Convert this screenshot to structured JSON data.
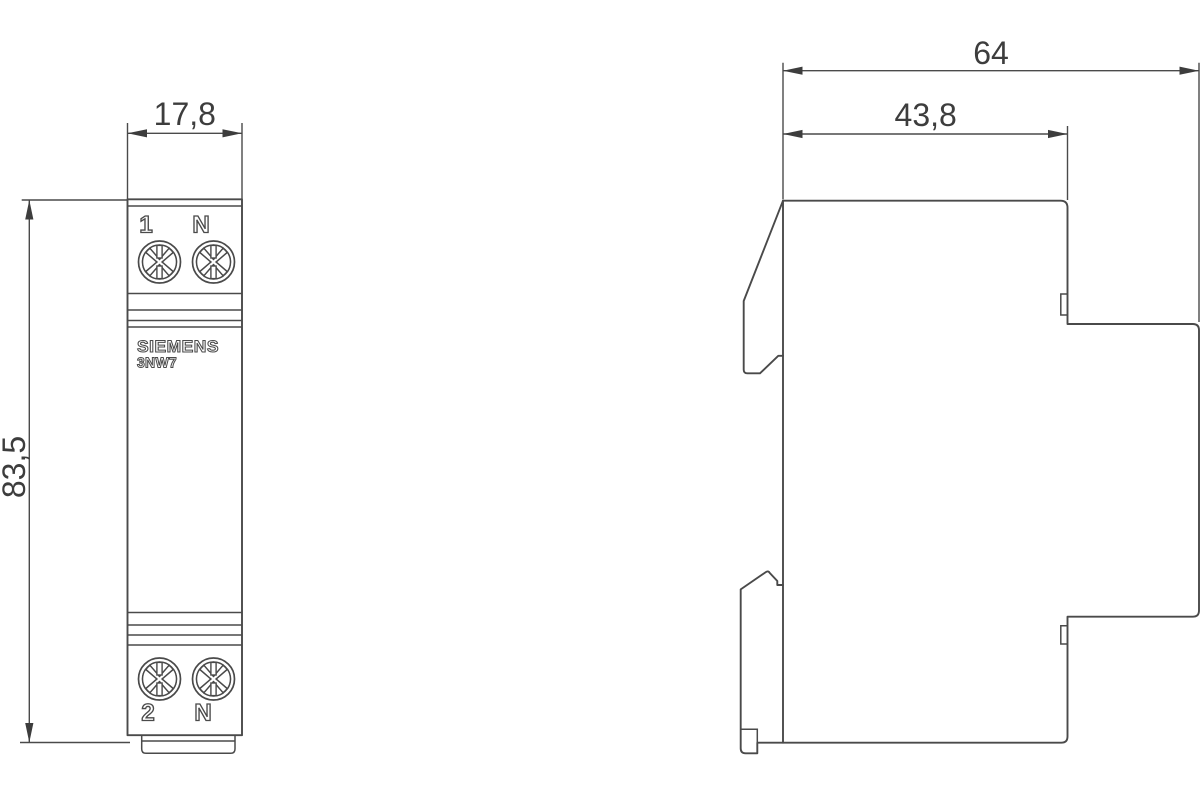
{
  "colors": {
    "background": "#ffffff",
    "line": "#4a4a4a",
    "text": "#3d3d3d"
  },
  "front_view": {
    "dim_width": "17,8",
    "dim_height": "83,5",
    "terminal_top_left": "1",
    "terminal_top_right": "N",
    "terminal_bottom_left": "2",
    "terminal_bottom_right": "N",
    "brand": "SIEMENS",
    "model": "3NW7"
  },
  "side_view": {
    "dim_depth": "64",
    "dim_upper_depth": "43,8"
  }
}
